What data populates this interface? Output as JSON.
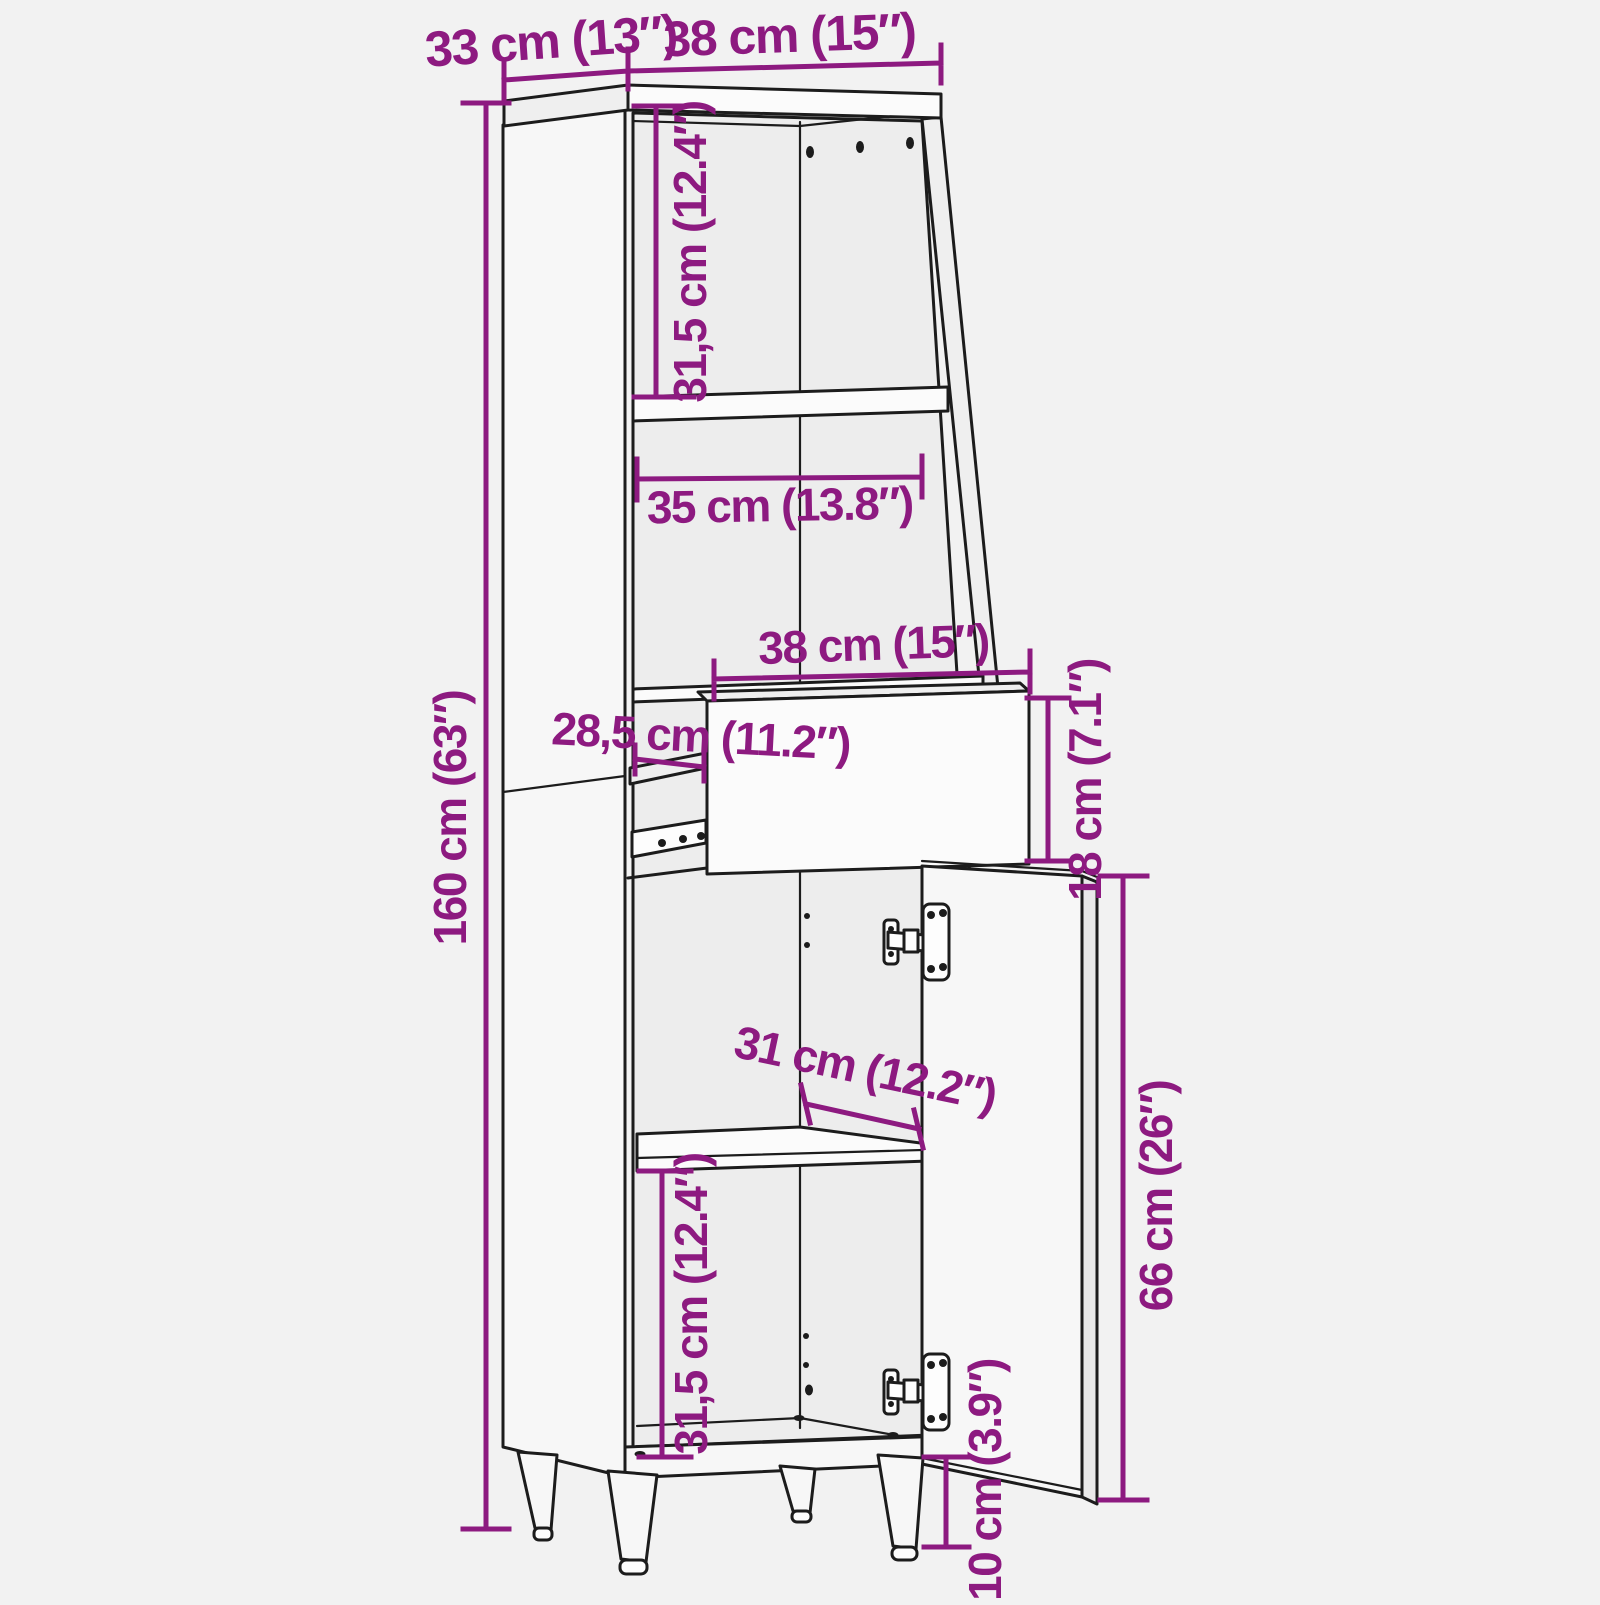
{
  "colors": {
    "accent": "#8d1a80",
    "line_art": "#1c1c1c",
    "background": "#f2f2f2"
  },
  "diagram": {
    "subject": "tall-cabinet-dimension-diagram-with-open-drawer-and-open-door",
    "dimensions": {
      "top_depth": "33 cm (13″)",
      "top_width": "38 cm (15″)",
      "upper_compartment_height": "31,5 cm (12.4″)",
      "interior_width": "35 cm (13.8″)",
      "drawer_width": "38 cm (15″)",
      "drawer_extension_depth": "28,5 cm (11.2″)",
      "drawer_height": "18 cm (7.1″)",
      "overall_height": "160 cm (63″)",
      "shelf_depth": "31 cm (12.2″)",
      "lower_compartment_height": "31,5 cm (12.4″)",
      "door_height": "66 cm (26″)",
      "leg_height": "10 cm (3.9″)"
    }
  }
}
